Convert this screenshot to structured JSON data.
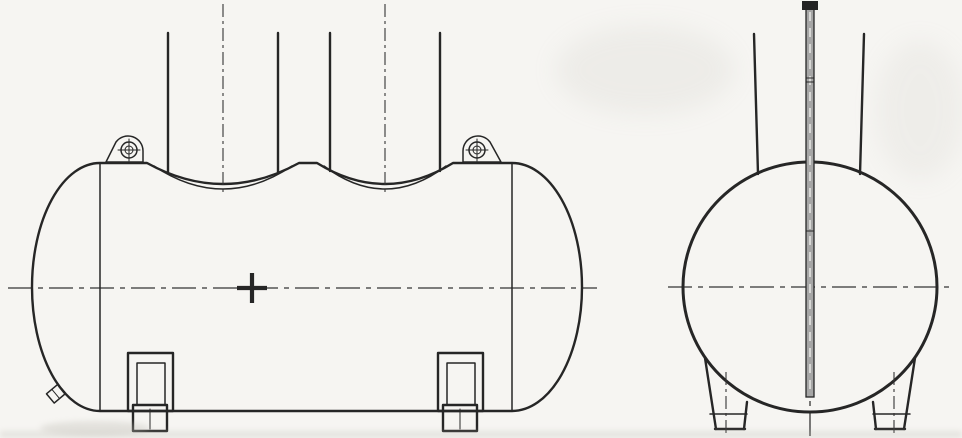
{
  "drawing": {
    "kind": "engineering-line-drawing",
    "subject": "horizontal-cylindrical-storage-tank",
    "views": [
      "side-elevation",
      "end-elevation"
    ],
    "components": [
      "tank-shell",
      "dished-head-left",
      "dished-head-right",
      "manway-neck-1",
      "manway-neck-2",
      "bolted-flange-cover",
      "reinforcement-pad-arc",
      "lifting-lug-left",
      "lifting-lug-right",
      "saddle-support-1",
      "saddle-support-2",
      "drain-nozzle",
      "center-mark",
      "dash-dot-centerlines",
      "end-shell-circle",
      "support-leg-left",
      "support-leg-right",
      "internal-dip-tube",
      "dip-tube-cap"
    ]
  },
  "colors": {
    "bg": "#f6f5f2",
    "line": "#262626",
    "dark-fill": "#242424",
    "slit": "#e6e4de",
    "tube-fill": "#a6a6a6",
    "tube-dash": "#ededea",
    "centerline": "#343434",
    "artifact": "#b9b7ae"
  }
}
